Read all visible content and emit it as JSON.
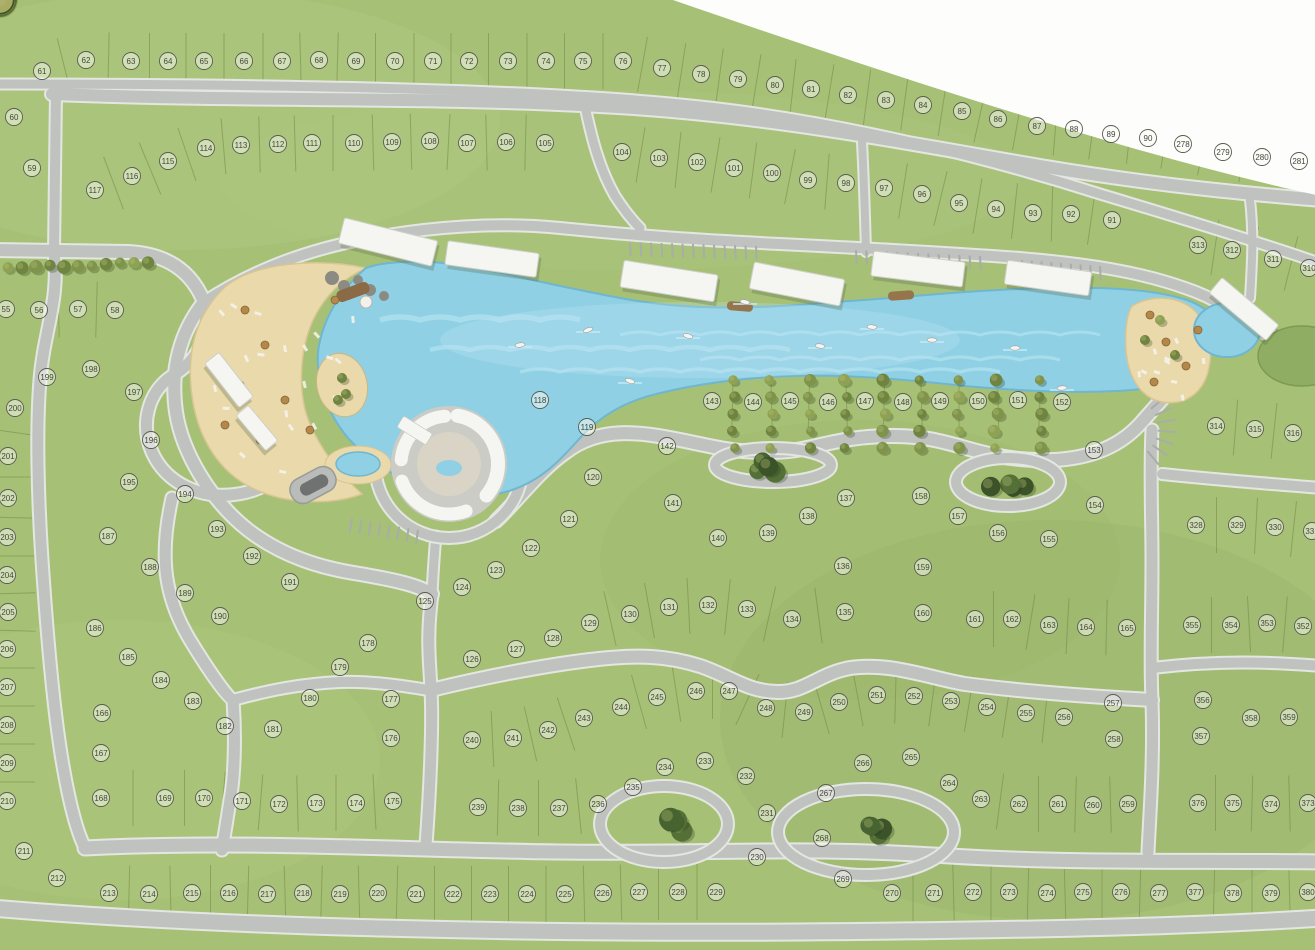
{
  "map": {
    "type": "residential-masterplan-siteplan",
    "colors": {
      "grass": "#a6c176",
      "grass_light": "#b7d08a",
      "grass_dark": "#93b066",
      "road": "#bfc2be",
      "road_edge": "#e4e6e2",
      "water": "#8fd0e5",
      "water_light": "#c2e9f4",
      "sand": "#ead9ab",
      "forest_dark": "#3c5329",
      "forest_olive": "#7f934a",
      "building_white": "#f5f5f1",
      "badge_ring": "#5c5c52",
      "badge_text": "#45453c",
      "outside_white": "#fdfdfc"
    },
    "lots": [
      {
        "n": 55,
        "x": 6,
        "y": 309
      },
      {
        "n": 56,
        "x": 39,
        "y": 310
      },
      {
        "n": 57,
        "x": 78,
        "y": 309
      },
      {
        "n": 58,
        "x": 115,
        "y": 310
      },
      {
        "n": 59,
        "x": 32,
        "y": 168
      },
      {
        "n": 60,
        "x": 14,
        "y": 117
      },
      {
        "n": 61,
        "x": 42,
        "y": 71
      },
      {
        "n": 62,
        "x": 86,
        "y": 60
      },
      {
        "n": 63,
        "x": 131,
        "y": 61
      },
      {
        "n": 64,
        "x": 168,
        "y": 61
      },
      {
        "n": 65,
        "x": 204,
        "y": 61
      },
      {
        "n": 66,
        "x": 244,
        "y": 61
      },
      {
        "n": 67,
        "x": 282,
        "y": 61
      },
      {
        "n": 68,
        "x": 319,
        "y": 60
      },
      {
        "n": 69,
        "x": 356,
        "y": 61
      },
      {
        "n": 70,
        "x": 395,
        "y": 61
      },
      {
        "n": 71,
        "x": 433,
        "y": 61
      },
      {
        "n": 72,
        "x": 469,
        "y": 61
      },
      {
        "n": 73,
        "x": 508,
        "y": 61
      },
      {
        "n": 74,
        "x": 546,
        "y": 61
      },
      {
        "n": 75,
        "x": 583,
        "y": 61
      },
      {
        "n": 76,
        "x": 623,
        "y": 61
      },
      {
        "n": 77,
        "x": 662,
        "y": 68
      },
      {
        "n": 78,
        "x": 701,
        "y": 74
      },
      {
        "n": 79,
        "x": 738,
        "y": 79
      },
      {
        "n": 80,
        "x": 775,
        "y": 85
      },
      {
        "n": 81,
        "x": 811,
        "y": 89
      },
      {
        "n": 82,
        "x": 848,
        "y": 95
      },
      {
        "n": 83,
        "x": 886,
        "y": 100
      },
      {
        "n": 84,
        "x": 923,
        "y": 105
      },
      {
        "n": 85,
        "x": 962,
        "y": 111
      },
      {
        "n": 86,
        "x": 998,
        "y": 119
      },
      {
        "n": 87,
        "x": 1037,
        "y": 126
      },
      {
        "n": 88,
        "x": 1074,
        "y": 129
      },
      {
        "n": 89,
        "x": 1111,
        "y": 134
      },
      {
        "n": 90,
        "x": 1148,
        "y": 138
      },
      {
        "n": 278,
        "x": 1183,
        "y": 144
      },
      {
        "n": 279,
        "x": 1223,
        "y": 152
      },
      {
        "n": 280,
        "x": 1262,
        "y": 157
      },
      {
        "n": 281,
        "x": 1299,
        "y": 161
      },
      {
        "n": 117,
        "x": 95,
        "y": 190
      },
      {
        "n": 116,
        "x": 132,
        "y": 176
      },
      {
        "n": 115,
        "x": 168,
        "y": 161
      },
      {
        "n": 114,
        "x": 206,
        "y": 148
      },
      {
        "n": 113,
        "x": 241,
        "y": 145
      },
      {
        "n": 112,
        "x": 278,
        "y": 144
      },
      {
        "n": 111,
        "x": 312,
        "y": 143
      },
      {
        "n": 110,
        "x": 354,
        "y": 143
      },
      {
        "n": 109,
        "x": 392,
        "y": 142
      },
      {
        "n": 108,
        "x": 430,
        "y": 141
      },
      {
        "n": 107,
        "x": 467,
        "y": 143
      },
      {
        "n": 106,
        "x": 506,
        "y": 142
      },
      {
        "n": 105,
        "x": 545,
        "y": 143
      },
      {
        "n": 104,
        "x": 622,
        "y": 152
      },
      {
        "n": 103,
        "x": 659,
        "y": 158
      },
      {
        "n": 102,
        "x": 697,
        "y": 162
      },
      {
        "n": 101,
        "x": 734,
        "y": 168
      },
      {
        "n": 100,
        "x": 772,
        "y": 173
      },
      {
        "n": 99,
        "x": 808,
        "y": 180
      },
      {
        "n": 98,
        "x": 846,
        "y": 183
      },
      {
        "n": 97,
        "x": 884,
        "y": 188
      },
      {
        "n": 96,
        "x": 922,
        "y": 194
      },
      {
        "n": 95,
        "x": 959,
        "y": 203
      },
      {
        "n": 94,
        "x": 996,
        "y": 209
      },
      {
        "n": 93,
        "x": 1033,
        "y": 213
      },
      {
        "n": 92,
        "x": 1071,
        "y": 214
      },
      {
        "n": 91,
        "x": 1112,
        "y": 220
      },
      {
        "n": 313,
        "x": 1198,
        "y": 245
      },
      {
        "n": 312,
        "x": 1232,
        "y": 250
      },
      {
        "n": 311,
        "x": 1273,
        "y": 259
      },
      {
        "n": 310,
        "x": 1309,
        "y": 268
      },
      {
        "n": 314,
        "x": 1216,
        "y": 426
      },
      {
        "n": 315,
        "x": 1255,
        "y": 429
      },
      {
        "n": 316,
        "x": 1293,
        "y": 433
      },
      {
        "n": 328,
        "x": 1196,
        "y": 525
      },
      {
        "n": 329,
        "x": 1237,
        "y": 525
      },
      {
        "n": 330,
        "x": 1275,
        "y": 527
      },
      {
        "n": 331,
        "x": 1312,
        "y": 531
      },
      {
        "n": 355,
        "x": 1192,
        "y": 625
      },
      {
        "n": 354,
        "x": 1231,
        "y": 625
      },
      {
        "n": 353,
        "x": 1267,
        "y": 623
      },
      {
        "n": 352,
        "x": 1303,
        "y": 626
      },
      {
        "n": 356,
        "x": 1203,
        "y": 700
      },
      {
        "n": 357,
        "x": 1201,
        "y": 736
      },
      {
        "n": 358,
        "x": 1251,
        "y": 718
      },
      {
        "n": 359,
        "x": 1289,
        "y": 717
      },
      {
        "n": 376,
        "x": 1198,
        "y": 803
      },
      {
        "n": 375,
        "x": 1233,
        "y": 803
      },
      {
        "n": 374,
        "x": 1271,
        "y": 804
      },
      {
        "n": 373,
        "x": 1308,
        "y": 803
      },
      {
        "n": 377,
        "x": 1195,
        "y": 892
      },
      {
        "n": 378,
        "x": 1233,
        "y": 893
      },
      {
        "n": 379,
        "x": 1271,
        "y": 893
      },
      {
        "n": 380,
        "x": 1308,
        "y": 892
      },
      {
        "n": 198,
        "x": 91,
        "y": 369
      },
      {
        "n": 199,
        "x": 47,
        "y": 377
      },
      {
        "n": 197,
        "x": 134,
        "y": 392
      },
      {
        "n": 200,
        "x": 15,
        "y": 408
      },
      {
        "n": 196,
        "x": 151,
        "y": 440
      },
      {
        "n": 201,
        "x": 8,
        "y": 456
      },
      {
        "n": 195,
        "x": 129,
        "y": 482
      },
      {
        "n": 194,
        "x": 185,
        "y": 494
      },
      {
        "n": 202,
        "x": 8,
        "y": 498
      },
      {
        "n": 193,
        "x": 217,
        "y": 529
      },
      {
        "n": 203,
        "x": 7,
        "y": 537
      },
      {
        "n": 187,
        "x": 108,
        "y": 536
      },
      {
        "n": 188,
        "x": 150,
        "y": 567
      },
      {
        "n": 192,
        "x": 252,
        "y": 556
      },
      {
        "n": 191,
        "x": 290,
        "y": 582
      },
      {
        "n": 204,
        "x": 7,
        "y": 575
      },
      {
        "n": 189,
        "x": 185,
        "y": 593
      },
      {
        "n": 205,
        "x": 8,
        "y": 612
      },
      {
        "n": 190,
        "x": 220,
        "y": 616
      },
      {
        "n": 186,
        "x": 95,
        "y": 628
      },
      {
        "n": 206,
        "x": 7,
        "y": 649
      },
      {
        "n": 185,
        "x": 128,
        "y": 657
      },
      {
        "n": 184,
        "x": 161,
        "y": 680
      },
      {
        "n": 207,
        "x": 7,
        "y": 687
      },
      {
        "n": 183,
        "x": 193,
        "y": 701
      },
      {
        "n": 166,
        "x": 102,
        "y": 713
      },
      {
        "n": 180,
        "x": 310,
        "y": 698
      },
      {
        "n": 182,
        "x": 225,
        "y": 726
      },
      {
        "n": 181,
        "x": 273,
        "y": 729
      },
      {
        "n": 208,
        "x": 7,
        "y": 725
      },
      {
        "n": 167,
        "x": 101,
        "y": 753
      },
      {
        "n": 209,
        "x": 7,
        "y": 763
      },
      {
        "n": 168,
        "x": 101,
        "y": 798
      },
      {
        "n": 169,
        "x": 165,
        "y": 798
      },
      {
        "n": 170,
        "x": 204,
        "y": 798
      },
      {
        "n": 171,
        "x": 242,
        "y": 801
      },
      {
        "n": 172,
        "x": 279,
        "y": 804
      },
      {
        "n": 173,
        "x": 316,
        "y": 803
      },
      {
        "n": 210,
        "x": 7,
        "y": 801
      },
      {
        "n": 211,
        "x": 24,
        "y": 851
      },
      {
        "n": 212,
        "x": 57,
        "y": 878
      },
      {
        "n": 174,
        "x": 356,
        "y": 803
      },
      {
        "n": 175,
        "x": 393,
        "y": 801
      },
      {
        "n": 176,
        "x": 391,
        "y": 738
      },
      {
        "n": 177,
        "x": 391,
        "y": 699
      },
      {
        "n": 178,
        "x": 368,
        "y": 643
      },
      {
        "n": 179,
        "x": 340,
        "y": 667
      },
      {
        "n": 118,
        "x": 540,
        "y": 400
      },
      {
        "n": 119,
        "x": 587,
        "y": 427
      },
      {
        "n": 120,
        "x": 593,
        "y": 477
      },
      {
        "n": 121,
        "x": 569,
        "y": 519
      },
      {
        "n": 122,
        "x": 531,
        "y": 548
      },
      {
        "n": 123,
        "x": 496,
        "y": 570
      },
      {
        "n": 124,
        "x": 462,
        "y": 587
      },
      {
        "n": 125,
        "x": 425,
        "y": 601
      },
      {
        "n": 126,
        "x": 472,
        "y": 659
      },
      {
        "n": 127,
        "x": 516,
        "y": 649
      },
      {
        "n": 128,
        "x": 553,
        "y": 638
      },
      {
        "n": 129,
        "x": 590,
        "y": 623
      },
      {
        "n": 130,
        "x": 630,
        "y": 614
      },
      {
        "n": 131,
        "x": 669,
        "y": 607
      },
      {
        "n": 132,
        "x": 708,
        "y": 605
      },
      {
        "n": 133,
        "x": 747,
        "y": 609
      },
      {
        "n": 134,
        "x": 792,
        "y": 619
      },
      {
        "n": 135,
        "x": 845,
        "y": 612
      },
      {
        "n": 136,
        "x": 843,
        "y": 566
      },
      {
        "n": 137,
        "x": 846,
        "y": 498
      },
      {
        "n": 138,
        "x": 808,
        "y": 516
      },
      {
        "n": 139,
        "x": 768,
        "y": 533
      },
      {
        "n": 140,
        "x": 718,
        "y": 538
      },
      {
        "n": 141,
        "x": 673,
        "y": 503
      },
      {
        "n": 142,
        "x": 667,
        "y": 446
      },
      {
        "n": 143,
        "x": 712,
        "y": 401
      },
      {
        "n": 144,
        "x": 753,
        "y": 402
      },
      {
        "n": 145,
        "x": 790,
        "y": 401
      },
      {
        "n": 146,
        "x": 828,
        "y": 402
      },
      {
        "n": 147,
        "x": 865,
        "y": 401
      },
      {
        "n": 148,
        "x": 903,
        "y": 402
      },
      {
        "n": 149,
        "x": 940,
        "y": 401
      },
      {
        "n": 150,
        "x": 978,
        "y": 401
      },
      {
        "n": 151,
        "x": 1018,
        "y": 400
      },
      {
        "n": 152,
        "x": 1062,
        "y": 402
      },
      {
        "n": 153,
        "x": 1094,
        "y": 450
      },
      {
        "n": 154,
        "x": 1095,
        "y": 505
      },
      {
        "n": 155,
        "x": 1049,
        "y": 539
      },
      {
        "n": 156,
        "x": 998,
        "y": 533
      },
      {
        "n": 157,
        "x": 958,
        "y": 516
      },
      {
        "n": 158,
        "x": 921,
        "y": 496
      },
      {
        "n": 159,
        "x": 923,
        "y": 567
      },
      {
        "n": 160,
        "x": 923,
        "y": 613
      },
      {
        "n": 161,
        "x": 975,
        "y": 619
      },
      {
        "n": 162,
        "x": 1012,
        "y": 619
      },
      {
        "n": 163,
        "x": 1049,
        "y": 625
      },
      {
        "n": 164,
        "x": 1086,
        "y": 627
      },
      {
        "n": 165,
        "x": 1127,
        "y": 628
      },
      {
        "n": 244,
        "x": 621,
        "y": 707
      },
      {
        "n": 245,
        "x": 657,
        "y": 697
      },
      {
        "n": 246,
        "x": 696,
        "y": 691
      },
      {
        "n": 247,
        "x": 729,
        "y": 691
      },
      {
        "n": 248,
        "x": 766,
        "y": 708
      },
      {
        "n": 249,
        "x": 804,
        "y": 712
      },
      {
        "n": 250,
        "x": 839,
        "y": 702
      },
      {
        "n": 251,
        "x": 877,
        "y": 695
      },
      {
        "n": 252,
        "x": 914,
        "y": 696
      },
      {
        "n": 253,
        "x": 951,
        "y": 701
      },
      {
        "n": 254,
        "x": 987,
        "y": 707
      },
      {
        "n": 255,
        "x": 1026,
        "y": 713
      },
      {
        "n": 256,
        "x": 1064,
        "y": 717
      },
      {
        "n": 257,
        "x": 1113,
        "y": 703
      },
      {
        "n": 258,
        "x": 1114,
        "y": 739
      },
      {
        "n": 259,
        "x": 1128,
        "y": 804
      },
      {
        "n": 260,
        "x": 1093,
        "y": 805
      },
      {
        "n": 261,
        "x": 1058,
        "y": 804
      },
      {
        "n": 262,
        "x": 1019,
        "y": 804
      },
      {
        "n": 263,
        "x": 981,
        "y": 799
      },
      {
        "n": 264,
        "x": 949,
        "y": 783
      },
      {
        "n": 265,
        "x": 911,
        "y": 757
      },
      {
        "n": 266,
        "x": 863,
        "y": 763
      },
      {
        "n": 267,
        "x": 826,
        "y": 793
      },
      {
        "n": 268,
        "x": 822,
        "y": 838
      },
      {
        "n": 269,
        "x": 843,
        "y": 879
      },
      {
        "n": 230,
        "x": 757,
        "y": 857
      },
      {
        "n": 231,
        "x": 767,
        "y": 813
      },
      {
        "n": 232,
        "x": 746,
        "y": 776
      },
      {
        "n": 233,
        "x": 705,
        "y": 761
      },
      {
        "n": 234,
        "x": 665,
        "y": 767
      },
      {
        "n": 235,
        "x": 633,
        "y": 787
      },
      {
        "n": 236,
        "x": 598,
        "y": 804
      },
      {
        "n": 237,
        "x": 559,
        "y": 808
      },
      {
        "n": 238,
        "x": 518,
        "y": 808
      },
      {
        "n": 239,
        "x": 478,
        "y": 807
      },
      {
        "n": 240,
        "x": 472,
        "y": 740
      },
      {
        "n": 241,
        "x": 513,
        "y": 738
      },
      {
        "n": 242,
        "x": 548,
        "y": 730
      },
      {
        "n": 243,
        "x": 584,
        "y": 718
      },
      {
        "n": 213,
        "x": 109,
        "y": 893
      },
      {
        "n": 214,
        "x": 149,
        "y": 894
      },
      {
        "n": 215,
        "x": 192,
        "y": 893
      },
      {
        "n": 216,
        "x": 229,
        "y": 893
      },
      {
        "n": 217,
        "x": 267,
        "y": 894
      },
      {
        "n": 218,
        "x": 303,
        "y": 893
      },
      {
        "n": 219,
        "x": 340,
        "y": 894
      },
      {
        "n": 220,
        "x": 378,
        "y": 893
      },
      {
        "n": 221,
        "x": 416,
        "y": 894
      },
      {
        "n": 222,
        "x": 453,
        "y": 894
      },
      {
        "n": 223,
        "x": 490,
        "y": 894
      },
      {
        "n": 224,
        "x": 527,
        "y": 894
      },
      {
        "n": 225,
        "x": 565,
        "y": 894
      },
      {
        "n": 226,
        "x": 603,
        "y": 893
      },
      {
        "n": 227,
        "x": 639,
        "y": 892
      },
      {
        "n": 228,
        "x": 678,
        "y": 892
      },
      {
        "n": 229,
        "x": 716,
        "y": 892
      },
      {
        "n": 270,
        "x": 892,
        "y": 893
      },
      {
        "n": 271,
        "x": 934,
        "y": 893
      },
      {
        "n": 272,
        "x": 973,
        "y": 892
      },
      {
        "n": 273,
        "x": 1009,
        "y": 892
      },
      {
        "n": 274,
        "x": 1047,
        "y": 893
      },
      {
        "n": 275,
        "x": 1083,
        "y": 892
      },
      {
        "n": 276,
        "x": 1121,
        "y": 892
      },
      {
        "n": 277,
        "x": 1159,
        "y": 893
      }
    ]
  }
}
